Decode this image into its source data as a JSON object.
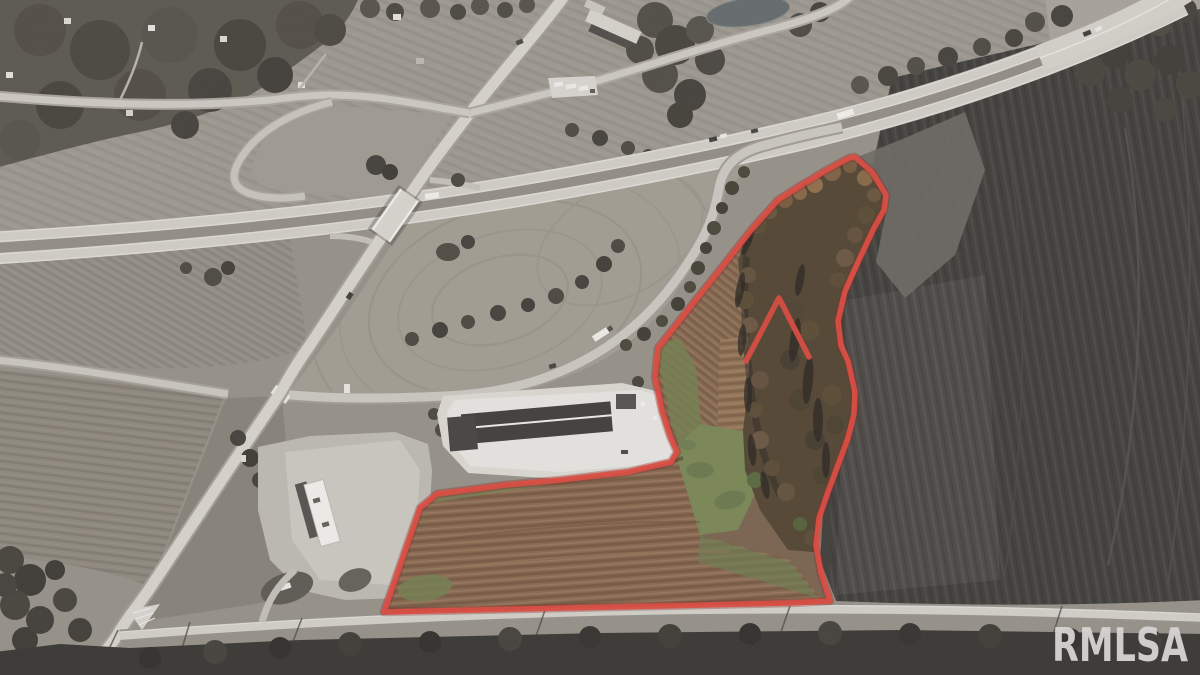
{
  "watermark": {
    "text": "RMLSA",
    "color": "#d6d5d3"
  },
  "parcel": {
    "outline_points": "849,158 825,171 800,186 778,200 752,229 730,257 695,301 665,339 658,348 655,377 662,411 670,436 677,452 671,462 628,472 560,480 505,485 437,494 420,508 404,554 384,612 520,609 660,606 790,603 830,601 821,573 816,545 819,518 828,492 838,465 848,438 854,414 855,392 848,361 841,346 838,321 845,291 858,262 874,228 884,210 886,195 872,172 855,157",
    "notch_points": "746,361 779,298 809,357",
    "boundary_color": "#df382c"
  }
}
